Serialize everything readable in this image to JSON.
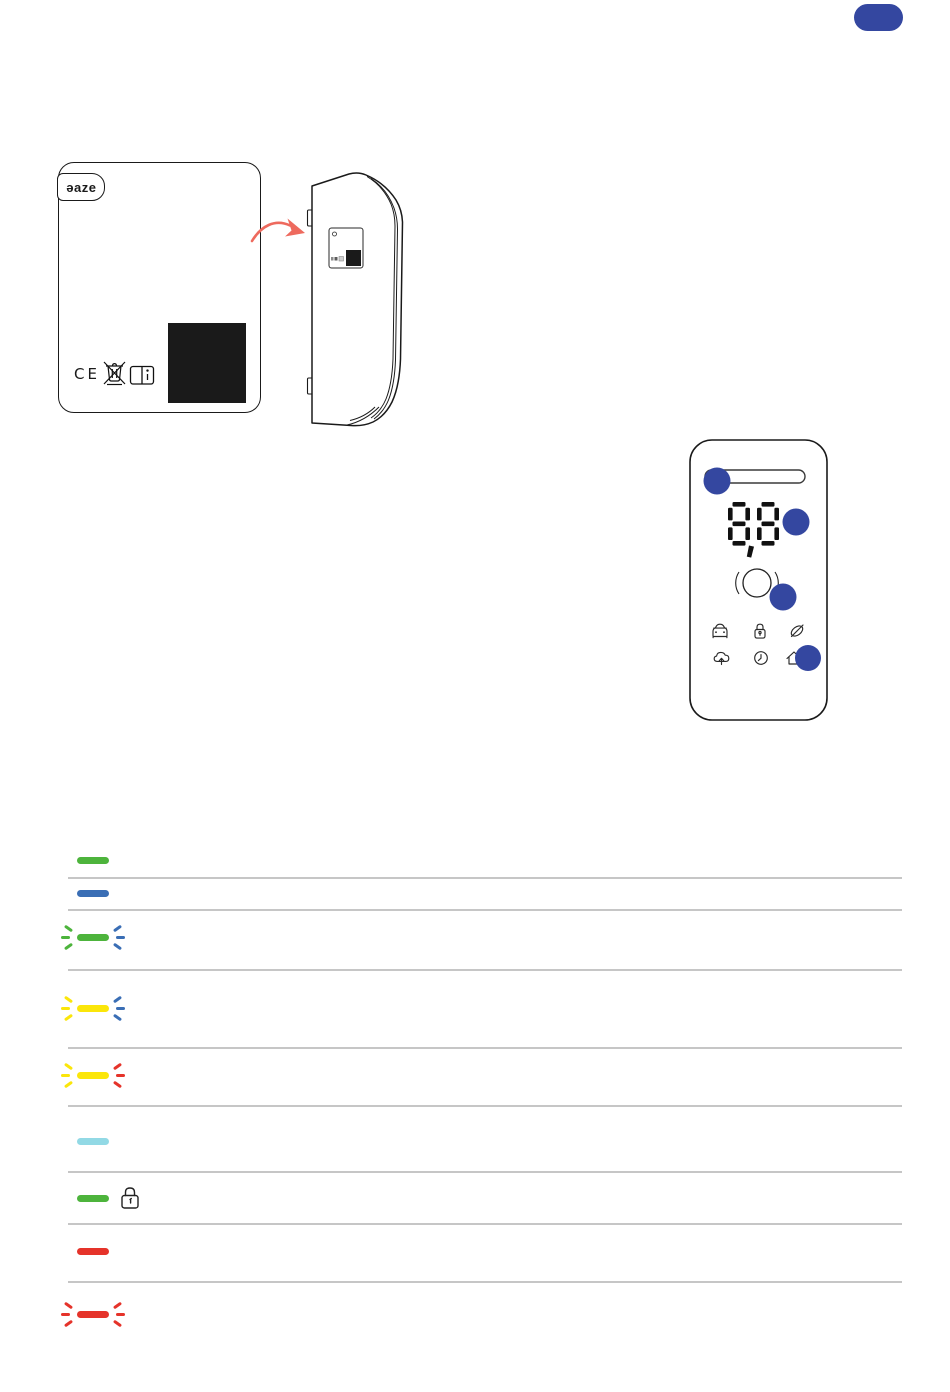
{
  "corner_badge": {
    "color": "#3447A0"
  },
  "device_front": {
    "logo_text": "ǝaze",
    "ce_mark_text": "CE",
    "icons": [
      "weee-crossed-bin-icon",
      "manual-book-icon"
    ],
    "label_area_color": "#1a1a1a"
  },
  "device_side": {
    "features": [
      "mounting-tabs",
      "product-label",
      "qr-area"
    ]
  },
  "arrow_color": "#EE6A5E",
  "control_panel": {
    "display_value": "8,8",
    "callout_color": "#3447A0",
    "callout_count": 4,
    "led_bar": "pill-outline",
    "button": "round-touch-button",
    "status_icons_row1": [
      "car-icon",
      "lock-icon",
      "leaf-icon"
    ],
    "status_icons_row2": [
      "cloud-upload-icon",
      "clock-icon",
      "home-icon"
    ]
  },
  "led_table": {
    "rows": [
      {
        "bar_color": "#4DB43C",
        "pattern": "solid"
      },
      {
        "bar_color": "#3A6EB5",
        "pattern": "solid"
      },
      {
        "bar_color": "#4DB43C",
        "pattern": "blinking",
        "left_ray_color": "#4DB43C",
        "right_ray_color": "#3A6EB5"
      },
      {
        "bar_color": "#FBE60A",
        "pattern": "blinking",
        "left_ray_color": "#FBE60A",
        "right_ray_color": "#3A6EB5"
      },
      {
        "bar_color": "#FBE60A",
        "pattern": "blinking",
        "left_ray_color": "#FBE60A",
        "right_ray_color": "#E5332A"
      },
      {
        "bar_color": "#92D9E5",
        "pattern": "solid"
      },
      {
        "bar_color": "#4DB43C",
        "pattern": "solid",
        "lock_icon": true
      },
      {
        "bar_color": "#E5332A",
        "pattern": "solid"
      },
      {
        "bar_color": "#E5332A",
        "pattern": "blinking",
        "left_ray_color": "#E5332A",
        "right_ray_color": "#E5332A"
      }
    ]
  }
}
